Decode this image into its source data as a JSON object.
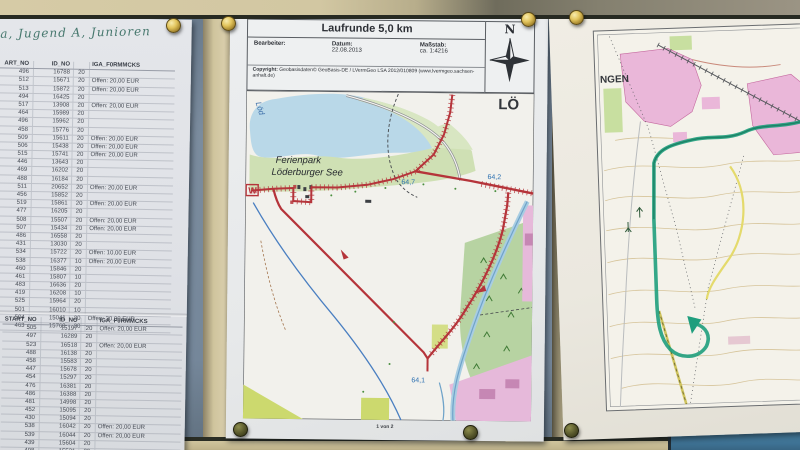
{
  "handwriting": {
    "text": "ga, Jugend A, Junioren"
  },
  "left_panel": {
    "sheet1": {
      "headers": [
        "ART_NO",
        "ID_NO",
        "IGA_F0RMMCKS",
        ""
      ],
      "rows": [
        [
          "496",
          "16788",
          "20",
          ""
        ],
        [
          "512",
          "15671",
          "20",
          "Offen: 20,00 EUR"
        ],
        [
          "513",
          "15872",
          "20",
          "Offen: 20,00 EUR"
        ],
        [
          "494",
          "16425",
          "20",
          ""
        ],
        [
          "517",
          "13908",
          "20",
          "Offen: 20,00 EUR"
        ],
        [
          "464",
          "15989",
          "20",
          ""
        ],
        [
          "496",
          "15962",
          "20",
          ""
        ],
        [
          "458",
          "15776",
          "20",
          ""
        ],
        [
          "509",
          "15611",
          "20",
          "Offen: 20,00 EUR"
        ],
        [
          "506",
          "15438",
          "20",
          "Offen: 20,00 EUR"
        ],
        [
          "515",
          "15741",
          "20",
          "Offen: 20,00 EUR"
        ],
        [
          "446",
          "13643",
          "20",
          ""
        ],
        [
          "469",
          "16202",
          "20",
          ""
        ],
        [
          "488",
          "16184",
          "20",
          ""
        ],
        [
          "511",
          "20652",
          "20",
          "Offen: 20,00 EUR"
        ],
        [
          "456",
          "15852",
          "20",
          ""
        ],
        [
          "519",
          "15861",
          "20",
          "Offen: 20,00 EUR"
        ],
        [
          "477",
          "16205",
          "20",
          ""
        ],
        [
          "508",
          "15507",
          "20",
          "Offen: 20,00 EUR"
        ],
        [
          "507",
          "15434",
          "20",
          "Offen: 20,00 EUR"
        ],
        [
          "486",
          "16558",
          "20",
          ""
        ],
        [
          "431",
          "13030",
          "20",
          ""
        ],
        [
          "534",
          "15722",
          "20",
          "Offen: 10,00 EUR"
        ],
        [
          "538",
          "16377",
          "10",
          "Offen: 20,00 EUR"
        ],
        [
          "460",
          "15846",
          "20",
          ""
        ],
        [
          "461",
          "15807",
          "10",
          ""
        ],
        [
          "483",
          "16636",
          "20",
          ""
        ],
        [
          "419",
          "16208",
          "10",
          ""
        ],
        [
          "525",
          "15964",
          "20",
          ""
        ],
        [
          "501",
          "16010",
          "10",
          ""
        ],
        [
          "504",
          "15041",
          "20",
          "Offen: 20,00 EUR"
        ],
        [
          "463",
          "15769",
          "20",
          ""
        ]
      ]
    },
    "sheet2": {
      "headers": [
        "START_NO",
        "ID_NO",
        "IGA_F0RMMCKS",
        ""
      ],
      "rows": [
        [
          "505",
          "15197",
          "20",
          "Offen: 20,00 EUR"
        ],
        [
          "497",
          "16289",
          "20",
          ""
        ],
        [
          "523",
          "16518",
          "20",
          "Offen: 20,00 EUR"
        ],
        [
          "488",
          "16138",
          "20",
          ""
        ],
        [
          "458",
          "15583",
          "20",
          ""
        ],
        [
          "447",
          "15678",
          "20",
          ""
        ],
        [
          "454",
          "15297",
          "20",
          ""
        ],
        [
          "476",
          "16381",
          "20",
          ""
        ],
        [
          "486",
          "16388",
          "20",
          ""
        ],
        [
          "481",
          "14998",
          "20",
          ""
        ],
        [
          "452",
          "15095",
          "20",
          ""
        ],
        [
          "430",
          "15094",
          "20",
          ""
        ],
        [
          "538",
          "16042",
          "20",
          "Offen: 20,00 EUR"
        ],
        [
          "539",
          "16044",
          "20",
          "Offen: 20,00 EUR"
        ],
        [
          "439",
          "15604",
          "20",
          ""
        ],
        [
          "498",
          "15531",
          "20",
          ""
        ]
      ]
    }
  },
  "map_sheet": {
    "title": "Laufrunde 5,0 km",
    "bearbeiter_label": "Bearbeiter:",
    "datum_label": "Datum:",
    "datum_value": "22.08.2013",
    "massstab_label": "Maßstab:",
    "massstab_value": "ca. 1:4216",
    "copyright_label": "Copyright:",
    "copyright_text": "Geobasisdaten© GeoBasis-DE / LVermGeo LSA 2012/010809 (www.lvermgeo.sachsen-anhalt.de)",
    "compass_n": "N",
    "page_label": "1 von 2",
    "labels": {
      "ferienpark_line1": "Ferienpark",
      "ferienpark_line2": "Löderburger See",
      "town_partial": "LÖ",
      "lake_street": "Löd",
      "start_marker": "W",
      "km_64_7": "64,7",
      "km_64_2": "64,2",
      "km_64_1": "64,1"
    }
  },
  "right_sheet": {
    "labels": {
      "town_partial": "NGEN"
    }
  },
  "colors": {
    "route_red": "#b5343a",
    "route_green": "#1f9e7d",
    "lake_blue": "#b9d8e8",
    "board_beige": "#d2c7a2",
    "backing_slate": "#78899b",
    "panel_blue": "#3e7294",
    "brass": "#d9b94e"
  }
}
